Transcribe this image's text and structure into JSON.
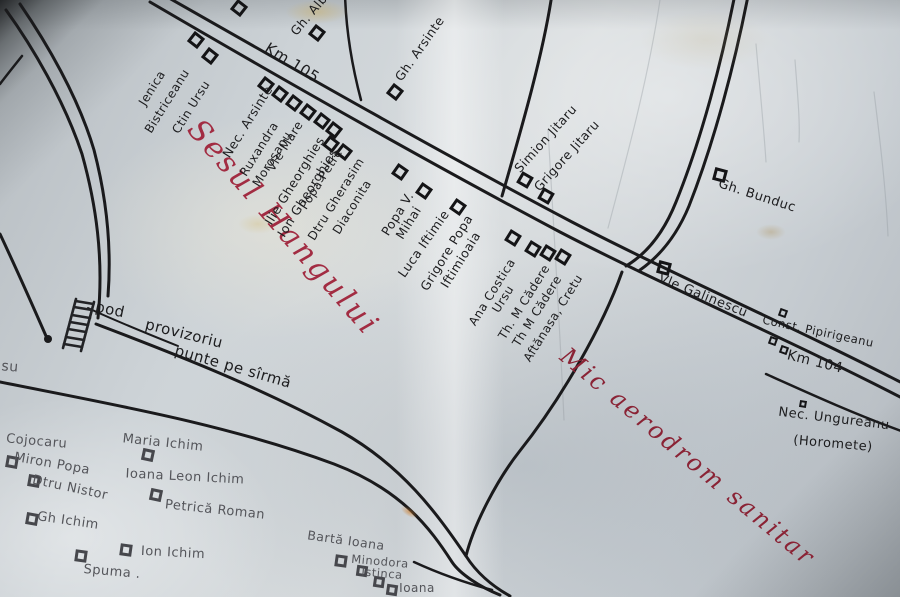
{
  "meta": {
    "title": "Hand-drawn village map photograph",
    "region_label_main": "Sesul Hangului",
    "region_label_secondary": "Mic aerodrom sanitar"
  },
  "colors": {
    "paper": "#cdd3d7",
    "ink": "#1d1d1f",
    "pencil": "#54555a",
    "red_ink": "#9b2b40",
    "red_ink_dark": "#8a2335"
  },
  "map": {
    "red_labels_note": "red ink place names",
    "labels": [
      {
        "id": "sesul-hangului",
        "text": "Sesul Hangului",
        "x": 283,
        "y": 228,
        "rot": 49,
        "size": 30,
        "cls": "red-script",
        "color": "#a22c42"
      },
      {
        "id": "mic-aerodrom",
        "text": "Mic aerodrom sanitar",
        "x": 688,
        "y": 457,
        "rot": 40,
        "size": 24,
        "cls": "red-script",
        "color": "#8a2335"
      },
      {
        "id": "jenica",
        "text": "Jenica",
        "x": 152,
        "y": 88,
        "rot": -58,
        "size": 12
      },
      {
        "id": "bistriceanu",
        "text": "Bistriceanu",
        "x": 167,
        "y": 101,
        "rot": -58,
        "size": 12
      },
      {
        "id": "ctin-ursu",
        "text": "Ctin Ursu",
        "x": 191,
        "y": 107,
        "rot": -58,
        "size": 12
      },
      {
        "id": "nec-arsinte",
        "text": "Nec. Arsinte",
        "x": 248,
        "y": 122,
        "rot": -58,
        "size": 12.5
      },
      {
        "id": "ruxandra",
        "text": "Ruxandra",
        "x": 259,
        "y": 149,
        "rot": -58,
        "size": 12
      },
      {
        "id": "morosanu",
        "text": "Morosanu",
        "x": 272,
        "y": 159,
        "rot": -58,
        "size": 12
      },
      {
        "id": "vle-mare",
        "text": "Vle Mare",
        "x": 285,
        "y": 146,
        "rot": -58,
        "size": 12
      },
      {
        "id": "ilie-gheorghies",
        "text": "Ilie Gheorghies",
        "x": 295,
        "y": 181,
        "rot": -58,
        "size": 12.5
      },
      {
        "id": "ion-gheorghies",
        "text": "Ion Gheorghies",
        "x": 308,
        "y": 193,
        "rot": -58,
        "size": 12.5
      },
      {
        "id": "popa-petre",
        "text": "Popa Petre",
        "x": 321,
        "y": 179,
        "rot": -58,
        "size": 12
      },
      {
        "id": "dtru-gherasim",
        "text": "Dtru Gherasim",
        "x": 336,
        "y": 199,
        "rot": -58,
        "size": 12
      },
      {
        "id": "diaconita",
        "text": "Diaconita",
        "x": 352,
        "y": 207,
        "rot": -58,
        "size": 12
      },
      {
        "id": "popa-v",
        "text": "Popa V.",
        "x": 398,
        "y": 214,
        "rot": -58,
        "size": 12.5
      },
      {
        "id": "mihai",
        "text": "Mihai",
        "x": 409,
        "y": 223,
        "rot": -58,
        "size": 12.5
      },
      {
        "id": "luca-iftimie",
        "text": "Luca Iftimie",
        "x": 424,
        "y": 244,
        "rot": -55,
        "size": 12.5
      },
      {
        "id": "grigore-popa",
        "text": "Grigore Popa",
        "x": 447,
        "y": 253,
        "rot": -58,
        "size": 12.5
      },
      {
        "id": "iftimioaia",
        "text": "Iftimioaia",
        "x": 461,
        "y": 260,
        "rot": -58,
        "size": 12.5
      },
      {
        "id": "ana-costica",
        "text": "Ana Costica",
        "x": 492,
        "y": 292,
        "rot": -58,
        "size": 12
      },
      {
        "id": "ursu",
        "text": "Ursu",
        "x": 503,
        "y": 299,
        "rot": -58,
        "size": 12
      },
      {
        "id": "th-m-cadere-1",
        "text": "Th. M Cădere",
        "x": 524,
        "y": 302,
        "rot": -58,
        "size": 12
      },
      {
        "id": "th-m-cadere-2",
        "text": "Th M Cădere",
        "x": 537,
        "y": 311,
        "rot": -58,
        "size": 12
      },
      {
        "id": "aftanasa-cretu",
        "text": "Aftănasa, Cretu",
        "x": 553,
        "y": 318,
        "rot": -58,
        "size": 12
      },
      {
        "id": "simion-jitaru",
        "text": "Simion Jitaru",
        "x": 546,
        "y": 139,
        "rot": -48,
        "size": 12.5
      },
      {
        "id": "grigore-jitaru",
        "text": "Grigore Jitaru",
        "x": 567,
        "y": 156,
        "rot": -48,
        "size": 12.5
      },
      {
        "id": "gh-arsinte",
        "text": "Gh. Arsinte",
        "x": 420,
        "y": 49,
        "rot": -55,
        "size": 12.5
      },
      {
        "id": "gh-albu",
        "text": "Gh. Albu",
        "x": 312,
        "y": 12,
        "rot": -50,
        "size": 12.5
      },
      {
        "id": "km-105",
        "text": "Km 105",
        "x": 292,
        "y": 63,
        "rot": 32,
        "size": 15
      },
      {
        "id": "gh-bunduc",
        "text": "Gh. Bunduc",
        "x": 757,
        "y": 196,
        "rot": 18,
        "size": 13
      },
      {
        "id": "vle-galinescu",
        "text": "Vle Galinescu",
        "x": 703,
        "y": 296,
        "rot": 22,
        "size": 13
      },
      {
        "id": "const-pipirigeanu",
        "text": "Const. Pipirigeanu",
        "x": 818,
        "y": 332,
        "rot": 12,
        "size": 11.5
      },
      {
        "id": "km-104",
        "text": "Km 104",
        "x": 815,
        "y": 362,
        "rot": 14,
        "size": 14
      },
      {
        "id": "nec-ungureanu",
        "text": "Nec. Ungureanu",
        "x": 834,
        "y": 419,
        "rot": 7,
        "size": 13
      },
      {
        "id": "horomete",
        "text": "(Horomete)",
        "x": 833,
        "y": 444,
        "rot": 5,
        "size": 13
      },
      {
        "id": "pod",
        "text": "pod",
        "x": 110,
        "y": 310,
        "rot": 12,
        "size": 15
      },
      {
        "id": "provizoriu",
        "text": "provizoriu",
        "x": 184,
        "y": 334,
        "rot": 14,
        "size": 15
      },
      {
        "id": "punte-pe-sirma",
        "text": "punte pe sîrmă",
        "x": 233,
        "y": 367,
        "rot": 16,
        "size": 15
      },
      {
        "id": "su",
        "text": "su",
        "x": 10,
        "y": 367,
        "rot": 5,
        "size": 14,
        "cls": "pencil"
      },
      {
        "id": "cojocaru",
        "text": "n Cojocaru",
        "x": 30,
        "y": 441,
        "rot": 5,
        "size": 13,
        "cls": "pencil"
      },
      {
        "id": "miron-popa",
        "text": "Miron Popa",
        "x": 52,
        "y": 464,
        "rot": 10,
        "size": 13,
        "cls": "pencil"
      },
      {
        "id": "dtru-nistor",
        "text": "Dtru Nistor",
        "x": 70,
        "y": 488,
        "rot": 12,
        "size": 13,
        "cls": "pencil"
      },
      {
        "id": "gh-ichim",
        "text": "Gh Ichim",
        "x": 68,
        "y": 521,
        "rot": 8,
        "size": 13,
        "cls": "pencil"
      },
      {
        "id": "maria-ichim",
        "text": "Maria Ichim",
        "x": 163,
        "y": 443,
        "rot": 6,
        "size": 13,
        "cls": "pencil"
      },
      {
        "id": "ioana-leon-ichim",
        "text": "Ioana Leon Ichim",
        "x": 185,
        "y": 477,
        "rot": 3,
        "size": 13,
        "cls": "pencil"
      },
      {
        "id": "petrica-roman",
        "text": "Petrică Roman",
        "x": 215,
        "y": 510,
        "rot": 6,
        "size": 13,
        "cls": "pencil"
      },
      {
        "id": "ion-ichim",
        "text": "Ion Ichim",
        "x": 173,
        "y": 553,
        "rot": 3,
        "size": 13,
        "cls": "pencil"
      },
      {
        "id": "spuma",
        "text": "Spuma .",
        "x": 112,
        "y": 572,
        "rot": 5,
        "size": 13,
        "cls": "pencil"
      },
      {
        "id": "barta-ioana",
        "text": "Bartă Ioana",
        "x": 346,
        "y": 541,
        "rot": 8,
        "size": 12.5,
        "cls": "pencil"
      },
      {
        "id": "minodora",
        "text": "Minodora",
        "x": 380,
        "y": 562,
        "rot": 5,
        "size": 11.5,
        "cls": "pencil"
      },
      {
        "id": "istinca",
        "text": "Istinca",
        "x": 382,
        "y": 574,
        "rot": 5,
        "size": 11.5,
        "cls": "pencil"
      },
      {
        "id": "ioana",
        "text": "Ioana",
        "x": 417,
        "y": 588,
        "rot": 0,
        "size": 12,
        "cls": "pencil"
      }
    ],
    "markers": [
      {
        "x": 239,
        "y": 8,
        "s": 13,
        "rot": 38
      },
      {
        "x": 317,
        "y": 33,
        "s": 13,
        "rot": 38
      },
      {
        "x": 196,
        "y": 40,
        "s": 13,
        "rot": 38
      },
      {
        "x": 210,
        "y": 56,
        "s": 13,
        "rot": 38
      },
      {
        "x": 395,
        "y": 92,
        "s": 13,
        "rot": 38
      },
      {
        "x": 266,
        "y": 85,
        "s": 13,
        "rot": 38
      },
      {
        "x": 280,
        "y": 94,
        "s": 13,
        "rot": 38
      },
      {
        "x": 294,
        "y": 103,
        "s": 13,
        "rot": 38
      },
      {
        "x": 308,
        "y": 112,
        "s": 13,
        "rot": 38
      },
      {
        "x": 322,
        "y": 121,
        "s": 13,
        "rot": 38
      },
      {
        "x": 334,
        "y": 130,
        "s": 13,
        "rot": 38
      },
      {
        "x": 331,
        "y": 144,
        "s": 13,
        "rot": 38
      },
      {
        "x": 344,
        "y": 152,
        "s": 13,
        "rot": 38
      },
      {
        "x": 400,
        "y": 172,
        "s": 13,
        "rot": 35
      },
      {
        "x": 424,
        "y": 191,
        "s": 13,
        "rot": 35
      },
      {
        "x": 458,
        "y": 207,
        "s": 13,
        "rot": 35
      },
      {
        "x": 525,
        "y": 180,
        "s": 13,
        "rot": 30
      },
      {
        "x": 546,
        "y": 196,
        "s": 13,
        "rot": 30
      },
      {
        "x": 513,
        "y": 238,
        "s": 13,
        "rot": 32
      },
      {
        "x": 533,
        "y": 249,
        "s": 13,
        "rot": 32
      },
      {
        "x": 548,
        "y": 253,
        "s": 13,
        "rot": 32
      },
      {
        "x": 563,
        "y": 257,
        "s": 13,
        "rot": 32
      },
      {
        "x": 720,
        "y": 175,
        "s": 13,
        "rot": 15
      },
      {
        "x": 664,
        "y": 268,
        "s": 13,
        "rot": 15
      },
      {
        "x": 783,
        "y": 313,
        "s": 8,
        "rot": 20,
        "cls": "small"
      },
      {
        "x": 773,
        "y": 341,
        "s": 8,
        "rot": 20,
        "cls": "small"
      },
      {
        "x": 784,
        "y": 350,
        "s": 8,
        "rot": 20,
        "cls": "small"
      },
      {
        "x": 803,
        "y": 404,
        "s": 7,
        "rot": 10,
        "cls": "small"
      },
      {
        "x": 12,
        "y": 462,
        "s": 12,
        "rot": 10,
        "cls": "pencil-sq"
      },
      {
        "x": 34,
        "y": 481,
        "s": 12,
        "rot": 10,
        "cls": "pencil-sq"
      },
      {
        "x": 32,
        "y": 519,
        "s": 12,
        "rot": 10,
        "cls": "pencil-sq"
      },
      {
        "x": 148,
        "y": 455,
        "s": 12,
        "rot": 12,
        "cls": "pencil-sq"
      },
      {
        "x": 156,
        "y": 495,
        "s": 12,
        "rot": 12,
        "cls": "pencil-sq"
      },
      {
        "x": 126,
        "y": 550,
        "s": 12,
        "rot": 8,
        "cls": "pencil-sq"
      },
      {
        "x": 81,
        "y": 556,
        "s": 12,
        "rot": 8,
        "cls": "pencil-sq"
      },
      {
        "x": 341,
        "y": 561,
        "s": 12,
        "rot": 8,
        "cls": "pencil-sq"
      },
      {
        "x": 362,
        "y": 571,
        "s": 11,
        "rot": 8,
        "cls": "pencil-sq"
      },
      {
        "x": 379,
        "y": 582,
        "s": 11,
        "rot": 8,
        "cls": "pencil-sq"
      },
      {
        "x": 392,
        "y": 590,
        "s": 11,
        "rot": 8,
        "cls": "pencil-sq"
      }
    ]
  }
}
